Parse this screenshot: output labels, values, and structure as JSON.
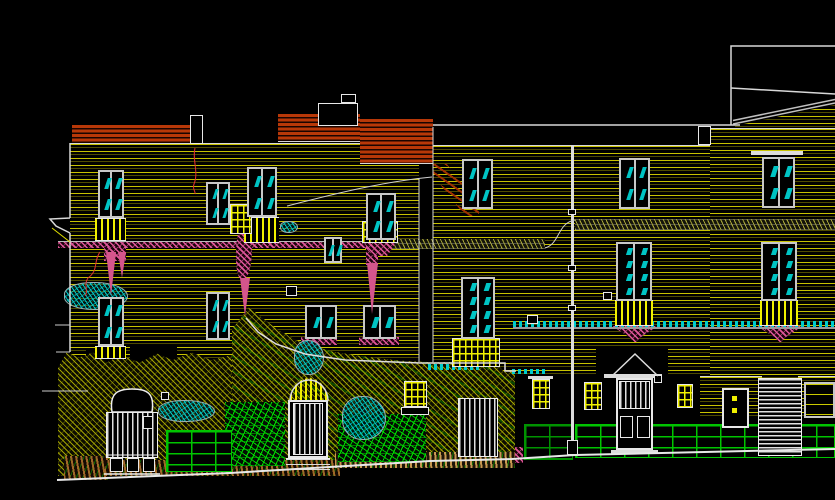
{
  "canvas": {
    "width": 835,
    "height": 500,
    "background": "#000000",
    "view_name": "street-elevation-cad-drawing"
  },
  "palette": {
    "course_yellow": "#d2cd00",
    "outline_white": "#d8d8d8",
    "brick_red": "#b83808",
    "hatch_pink": "#e0559a",
    "glazing_teal": "#00c4c4",
    "vegetation_olive": "#afaf00",
    "stone_green": "#00c400",
    "ground_brown": "#a06828",
    "crack_red": "#e03030"
  },
  "shapes": [
    {
      "name": "facade-courses-left",
      "cls": "courses",
      "x": 70,
      "y": 143,
      "w": 349,
      "h": 217
    },
    {
      "name": "facade-courses-right",
      "cls": "courses",
      "x": 433,
      "y": 145,
      "w": 277,
      "h": 230
    },
    {
      "name": "facade-courses-far-right",
      "cls": "courses",
      "x": 710,
      "y": 128,
      "w": 125,
      "h": 250
    },
    {
      "name": "roof-triangle-courses",
      "cls": "courses",
      "x": 735,
      "y": 101,
      "w": 100,
      "h": 27,
      "clip": "polygon(0 92%,100% 14%,100% 100%,0 100%)"
    },
    {
      "name": "courses-door5-wall",
      "cls": "courses",
      "x": 700,
      "y": 376,
      "w": 62,
      "h": 42
    },
    {
      "name": "courses-window20-wall",
      "cls": "courses",
      "x": 798,
      "y": 376,
      "w": 37,
      "h": 42
    },
    {
      "name": "party-recess-strip",
      "cls": "black",
      "x": 419,
      "y": 160,
      "w": 14,
      "h": 202
    },
    {
      "name": "pediment-backdrop",
      "cls": "black",
      "x": 596,
      "y": 348,
      "w": 72,
      "h": 30
    },
    {
      "name": "garden-pocket-1",
      "cls": "black",
      "x": 86,
      "y": 350,
      "w": 26,
      "h": 40
    },
    {
      "name": "garden-pocket-2",
      "cls": "black",
      "x": 130,
      "y": 346,
      "w": 47,
      "h": 42
    },
    {
      "name": "brick-parapet-left",
      "cls": "brick-red",
      "x": 72,
      "y": 125,
      "w": 118,
      "h": 19
    },
    {
      "name": "brick-parapet-mid",
      "cls": "brick-red",
      "x": 278,
      "y": 114,
      "w": 82,
      "h": 28
    },
    {
      "name": "brick-gable",
      "cls": "brick-red",
      "x": 360,
      "y": 119,
      "w": 73,
      "h": 45
    },
    {
      "name": "eaves-slope",
      "cls": "eaves",
      "x": 433,
      "y": 164,
      "w": 46,
      "h": 52,
      "clip": "polygon(0 0,30% 0,100% 78%,100% 100%,70% 100%,0 22%)"
    },
    {
      "name": "string-band-khaki-left",
      "cls": "hatch-khaki",
      "x": 365,
      "y": 239,
      "w": 180,
      "h": 10
    },
    {
      "name": "string-band-khaki-right",
      "cls": "hatch-khaki",
      "x": 575,
      "y": 219,
      "w": 260,
      "h": 11
    },
    {
      "name": "string-band-pink",
      "cls": "hatch-pink",
      "x": 58,
      "y": 241,
      "w": 308,
      "h": 7,
      "bt": "#bbbbbb"
    },
    {
      "name": "pink-drip-column",
      "cls": "hatch-pink",
      "x": 104,
      "y": 247,
      "w": 22,
      "h": 14
    },
    {
      "name": "downpipe-blob",
      "cls": "hatch-pink",
      "x": 236,
      "y": 224,
      "w": 16,
      "h": 56,
      "r": "55% 45% 60% 40%"
    },
    {
      "name": "downpipe-2-top",
      "cls": "hatch-pink",
      "x": 366,
      "y": 241,
      "w": 12,
      "h": 24
    },
    {
      "name": "corbel-window4",
      "cls": "hatch-pink",
      "x": 364,
      "y": 243,
      "w": 32,
      "h": 13,
      "clip": "polygon(0 0,100% 0,72% 100%,28% 100%)"
    },
    {
      "name": "corbel-window13",
      "cls": "hatch-pink",
      "x": 612,
      "y": 326,
      "w": 46,
      "h": 16,
      "clip": "polygon(0 0,100% 0,62% 70%,52% 100%,48% 100%,38% 70%)"
    },
    {
      "name": "corbel-window14",
      "cls": "hatch-pink",
      "x": 757,
      "y": 326,
      "w": 46,
      "h": 16,
      "clip": "polygon(0 0,100% 0,62% 70%,52% 100%,48% 100%,38% 70%)"
    },
    {
      "name": "sill-window10",
      "cls": "hatch-pink",
      "x": 301,
      "y": 337,
      "w": 36,
      "h": 8
    },
    {
      "name": "sill-window11",
      "cls": "hatch-pink",
      "x": 359,
      "y": 337,
      "w": 40,
      "h": 8
    },
    {
      "name": "pink-plinth-block",
      "cls": "hatch-pink",
      "x": 512,
      "y": 447,
      "w": 11,
      "h": 16
    },
    {
      "name": "garden-pink-patch",
      "cls": "hatch-pink",
      "x": 193,
      "y": 397,
      "w": 35,
      "h": 40,
      "clip": "polygon(15% 0,100% 25%,80% 100%,0 70%)"
    },
    {
      "name": "terrain-olive-left",
      "cls": "hatch-olive",
      "x": 58,
      "y": 350,
      "w": 174,
      "h": 126,
      "clip": "polygon(0 14%,5% 2%,12% 6%,20% 2%,28% 10%,36% 4%,47% 10%,57% 3%,66% 8%,77% 2%,88% 8%,100% 4%,100% 100%,0 100%)"
    },
    {
      "name": "terrain-olive-outbuilding",
      "cls": "hatch-olive2",
      "x": 232,
      "y": 306,
      "w": 283,
      "h": 156,
      "clip": "polygon(0 15%,6% 1%,11% 8%,16% 15%,24% 23%,35% 29%,45% 32%,59% 35%,70% 36%,93% 36%,96% 42%,100% 42%,100% 100%,0 100%)"
    },
    {
      "name": "ground-brown-corner",
      "cls": "ground-brown",
      "x": 64,
      "y": 456,
      "w": 44,
      "h": 24
    },
    {
      "name": "ground-brown-strip",
      "cls": "ground-brown",
      "x": 105,
      "y": 460,
      "w": 235,
      "h": 16
    },
    {
      "name": "ground-tan-path",
      "cls": "ground-tan",
      "x": 335,
      "y": 452,
      "w": 180,
      "h": 16
    },
    {
      "name": "stone-wall-left",
      "cls": "stone-green",
      "x": 225,
      "y": 402,
      "w": 60,
      "h": 64
    },
    {
      "name": "green-brick-wall-gate",
      "cls": "brick-green",
      "x": 166,
      "y": 430,
      "w": 66,
      "h": 42
    },
    {
      "name": "stone-wall-right",
      "cls": "stone-green",
      "x": 338,
      "y": 414,
      "w": 88,
      "h": 48
    },
    {
      "name": "green-brick-wall-dim",
      "cls": "brick-green",
      "x": 524,
      "y": 424,
      "w": 49,
      "h": 36,
      "op": 0.75
    },
    {
      "name": "green-brick-plinth-right",
      "cls": "brick-green",
      "x": 575,
      "y": 424,
      "w": 260,
      "h": 34
    },
    {
      "name": "ivy-bush-1",
      "cls": "bush-teal",
      "x": 64,
      "y": 282,
      "w": 64,
      "h": 28
    },
    {
      "name": "ivy-bush-2",
      "cls": "bush-teal",
      "x": 158,
      "y": 400,
      "w": 57,
      "h": 22
    },
    {
      "name": "ivy-bush-3",
      "cls": "bush-teal",
      "x": 342,
      "y": 396,
      "w": 44,
      "h": 44
    },
    {
      "name": "ivy-bush-4",
      "cls": "bush-teal",
      "x": 294,
      "y": 340,
      "w": 30,
      "h": 35
    },
    {
      "name": "ivy-squiggle",
      "cls": "bush-teal",
      "x": 280,
      "y": 221,
      "w": 18,
      "h": 12
    },
    {
      "name": "parapet-algae-1",
      "cls": "cable-teal",
      "x": 428,
      "y": 364,
      "w": 52,
      "h": 6
    },
    {
      "name": "parapet-algae-2",
      "cls": "cable-teal",
      "x": 512,
      "y": 369,
      "w": 35,
      "h": 5
    },
    {
      "name": "service-wire-bar",
      "cls": "cable",
      "x": 513,
      "y": 321,
      "w": 322,
      "h": 8
    },
    {
      "name": "wire-node-box",
      "cls": "outline-box",
      "x": 527,
      "y": 315,
      "w": 11,
      "h": 9
    },
    {
      "name": "balconette-window1",
      "cls": "balusters",
      "x": 95,
      "y": 218,
      "w": 31,
      "h": 23
    },
    {
      "name": "balconette-window3",
      "cls": "balusters",
      "x": 244,
      "y": 217,
      "w": 35,
      "h": 26
    },
    {
      "name": "oriel-grid-window2",
      "cls": "grid-yellow",
      "x": 230,
      "y": 204,
      "w": 22,
      "h": 30
    },
    {
      "name": "balcony-grid-window4",
      "cls": "grid-yellow",
      "x": 362,
      "y": 221,
      "w": 36,
      "h": 22
    },
    {
      "name": "sill-bars-window8",
      "cls": "balusters",
      "x": 95,
      "y": 346,
      "w": 31,
      "h": 13
    },
    {
      "name": "balconette-window13",
      "cls": "balusters",
      "x": 615,
      "y": 300,
      "w": 38,
      "h": 26
    },
    {
      "name": "balconette-window14",
      "cls": "balusters",
      "x": 760,
      "y": 300,
      "w": 38,
      "h": 26
    },
    {
      "name": "balcony-grid-window15",
      "cls": "grid-yellow",
      "x": 452,
      "y": 338,
      "w": 48,
      "h": 29
    },
    {
      "name": "door2-fanlight",
      "cls": "fan-yellow",
      "x": 290,
      "y": 378,
      "w": 38,
      "h": 23
    },
    {
      "name": "basement-grid-1",
      "cls": "grid-yellow",
      "x": 584,
      "y": 382,
      "w": 18,
      "h": 28
    },
    {
      "name": "basement-grid-2",
      "cls": "grid-yellow",
      "x": 677,
      "y": 384,
      "w": 16,
      "h": 24
    },
    {
      "name": "basement-grid-3",
      "cls": "grid-yellow",
      "x": 404,
      "y": 381,
      "w": 23,
      "h": 26
    },
    {
      "name": "planter-box",
      "cls": "outline-box",
      "x": 401,
      "y": 407,
      "w": 28,
      "h": 8
    },
    {
      "name": "basement-grid-4",
      "cls": "grid-yellow",
      "x": 532,
      "y": 379,
      "w": 18,
      "h": 30
    },
    {
      "name": "lintel-grid-4",
      "cls": "white-bar",
      "x": 528,
      "y": 376,
      "w": 25,
      "h": 3
    },
    {
      "name": "lintel-window7",
      "cls": "white-bar",
      "x": 751,
      "y": 151,
      "w": 52,
      "h": 4
    },
    {
      "name": "window-20",
      "cls": "window-plain",
      "x": 804,
      "y": 382,
      "w": 31,
      "h": 36
    },
    {
      "name": "gate-body",
      "cls": "slats-v",
      "x": 106,
      "y": 412,
      "w": 52,
      "h": 46
    },
    {
      "name": "gate-top-panel",
      "cls": "outline-box",
      "x": 117,
      "y": 394,
      "w": 31,
      "h": 15
    },
    {
      "name": "gate-panel-1",
      "cls": "outline-box",
      "x": 110,
      "y": 458,
      "w": 13,
      "h": 14
    },
    {
      "name": "gate-panel-2",
      "cls": "outline-box",
      "x": 127,
      "y": 458,
      "w": 12,
      "h": 14
    },
    {
      "name": "gate-panel-3",
      "cls": "outline-box",
      "x": 143,
      "y": 458,
      "w": 12,
      "h": 14
    },
    {
      "name": "gate-label-plate",
      "cls": "outline-box",
      "x": 143,
      "y": 416,
      "w": 10,
      "h": 13
    },
    {
      "name": "door2-frame",
      "cls": "door-frame",
      "x": 288,
      "y": 400,
      "w": 40,
      "h": 58
    },
    {
      "name": "door2-bars",
      "cls": "slats-v",
      "x": 293,
      "y": 403,
      "w": 30,
      "h": 52
    },
    {
      "name": "door2-steps",
      "cls": "steps",
      "x": 286,
      "y": 458,
      "w": 44,
      "h": 12
    },
    {
      "name": "door3-boarded",
      "cls": "slats-v",
      "x": 458,
      "y": 398,
      "w": 40,
      "h": 59
    },
    {
      "name": "door4-frame",
      "cls": "door-frame",
      "x": 616,
      "y": 378,
      "w": 37,
      "h": 72
    },
    {
      "name": "door4-bars",
      "cls": "slats-v",
      "x": 619,
      "y": 381,
      "w": 31,
      "h": 28
    },
    {
      "name": "door4-panel-1",
      "cls": "outline-box",
      "x": 620,
      "y": 416,
      "w": 13,
      "h": 22
    },
    {
      "name": "door4-panel-2",
      "cls": "outline-box",
      "x": 637,
      "y": 416,
      "w": 13,
      "h": 22
    },
    {
      "name": "door4-entablature",
      "cls": "white-bar",
      "x": 604,
      "y": 374,
      "w": 58,
      "h": 4
    },
    {
      "name": "door4-threshold",
      "cls": "white-bar",
      "x": 611,
      "y": 450,
      "w": 47,
      "h": 4
    },
    {
      "name": "door5-frame",
      "cls": "door-frame",
      "x": 722,
      "y": 388,
      "w": 27,
      "h": 40
    },
    {
      "name": "door5-knob-1",
      "cls": "yellow-dot",
      "x": 732,
      "y": 396,
      "w": 5,
      "h": 5
    },
    {
      "name": "door5-knob-2",
      "cls": "yellow-dot",
      "x": 732,
      "y": 408,
      "w": 5,
      "h": 5
    },
    {
      "name": "garage-door",
      "cls": "slats-h",
      "x": 758,
      "y": 378,
      "w": 44,
      "h": 78
    },
    {
      "name": "chimney",
      "cls": "outline-box",
      "x": 318,
      "y": 103,
      "w": 40,
      "h": 23
    },
    {
      "name": "chimney-cap",
      "cls": "outline-box",
      "x": 341,
      "y": 94,
      "w": 15,
      "h": 9
    },
    {
      "name": "parapet-box-left",
      "cls": "outline-box",
      "x": 190,
      "y": 115,
      "w": 13,
      "h": 29
    },
    {
      "name": "parapet-box-right",
      "cls": "outline-box",
      "x": 698,
      "y": 126,
      "w": 13,
      "h": 19
    },
    {
      "name": "party-wall-line",
      "cls": "white-bar",
      "x": 571,
      "y": 145,
      "w": 3,
      "h": 310
    },
    {
      "name": "party-node-1",
      "cls": "outline-box",
      "x": 568,
      "y": 209,
      "w": 8,
      "h": 6
    },
    {
      "name": "party-node-2",
      "cls": "outline-box",
      "x": 568,
      "y": 265,
      "w": 8,
      "h": 6
    },
    {
      "name": "party-node-3",
      "cls": "outline-box",
      "x": 568,
      "y": 305,
      "w": 8,
      "h": 6
    },
    {
      "name": "party-wall-base",
      "cls": "outline-box",
      "x": 567,
      "y": 440,
      "w": 11,
      "h": 15
    },
    {
      "name": "survey-marker-1",
      "cls": "outline-box",
      "x": 286,
      "y": 286,
      "w": 11,
      "h": 10
    },
    {
      "name": "survey-marker-2",
      "cls": "outline-box",
      "x": 603,
      "y": 292,
      "w": 9,
      "h": 8
    },
    {
      "name": "survey-marker-3",
      "cls": "outline-box",
      "x": 654,
      "y": 375,
      "w": 8,
      "h": 8
    },
    {
      "name": "survey-marker-4",
      "cls": "outline-box",
      "x": 161,
      "y": 392,
      "w": 8,
      "h": 8
    }
  ],
  "windows": [
    {
      "name": "window-1",
      "x": 98,
      "y": 170,
      "w": 26,
      "h": 48,
      "rows": 2
    },
    {
      "name": "window-2",
      "x": 206,
      "y": 182,
      "w": 24,
      "h": 43,
      "rows": 2
    },
    {
      "name": "window-3",
      "x": 247,
      "y": 167,
      "w": 30,
      "h": 50,
      "rows": 2
    },
    {
      "name": "window-4",
      "x": 366,
      "y": 193,
      "w": 30,
      "h": 47,
      "rows": 2
    },
    {
      "name": "window-5",
      "x": 462,
      "y": 159,
      "w": 31,
      "h": 50,
      "rows": 2
    },
    {
      "name": "window-6",
      "x": 619,
      "y": 158,
      "w": 31,
      "h": 51,
      "rows": 2
    },
    {
      "name": "window-7",
      "x": 762,
      "y": 157,
      "w": 33,
      "h": 51,
      "rows": 2
    },
    {
      "name": "window-8",
      "x": 98,
      "y": 297,
      "w": 26,
      "h": 49,
      "rows": 2
    },
    {
      "name": "window-9",
      "x": 206,
      "y": 292,
      "w": 24,
      "h": 48,
      "rows": 2
    },
    {
      "name": "window-10",
      "x": 305,
      "y": 305,
      "w": 32,
      "h": 34,
      "rows": 1
    },
    {
      "name": "window-11",
      "x": 363,
      "y": 305,
      "w": 33,
      "h": 34,
      "rows": 1
    },
    {
      "name": "window-12",
      "x": 324,
      "y": 237,
      "w": 18,
      "h": 26,
      "rows": 1
    },
    {
      "name": "window-13",
      "x": 616,
      "y": 242,
      "w": 36,
      "h": 59,
      "rows": 4
    },
    {
      "name": "window-14",
      "x": 761,
      "y": 242,
      "w": 36,
      "h": 59,
      "rows": 4
    },
    {
      "name": "window-15",
      "x": 461,
      "y": 277,
      "w": 34,
      "h": 62,
      "rows": 4
    }
  ],
  "paths": [
    {
      "name": "ground-line",
      "d": "M57,480 L230,473 L430,461 L512,459 L575,455 L835,449",
      "stroke": "#e8e8e8",
      "w": 2
    },
    {
      "name": "parapet-long-line",
      "d": "M433,125 L740,125",
      "stroke": "#d8d8d8",
      "w": 1.5
    },
    {
      "name": "roof-outline-topright",
      "d": "M731,125 L731,46 L835,46",
      "stroke": "#d8d8d8",
      "w": 1.5
    },
    {
      "name": "roof-ridge-line",
      "d": "M731,88 L835,94",
      "stroke": "#d8d8d8",
      "w": 1.5
    },
    {
      "name": "roof-diagonal-1",
      "d": "M733,124 L835,103",
      "stroke": "#c0c0c0",
      "w": 1.5
    },
    {
      "name": "roof-diagonal-2",
      "d": "M733,120.5 L835,99.5",
      "stroke": "#c0c0c0",
      "w": 1.5
    },
    {
      "name": "left-facade-edge",
      "d": "M70,143 L70,218 M70,218 L50,219 L56,226 L70,233 M70,233 L70,352",
      "stroke": "#d8d8d8",
      "w": 1.5
    },
    {
      "name": "cornice-yellow-line",
      "d": "M52,228 L70,242",
      "stroke": "#e0e000",
      "w": 1
    },
    {
      "name": "recess-left-edge",
      "d": "M419,178 L419,362",
      "stroke": "#d8d8d8",
      "w": 1
    },
    {
      "name": "recess-right-edge",
      "d": "M433,127 L433,362",
      "stroke": "#d8d8d8",
      "w": 1
    },
    {
      "name": "telephone-wire-curve",
      "d": "M287,206 C330,195 380,182 432,177",
      "stroke": "#cfcfcf",
      "w": 1
    },
    {
      "name": "band-s-connector",
      "d": "M545,248 C560,244 557,223 575,220",
      "stroke": "#cfcfcf",
      "w": 1
    },
    {
      "name": "crack-line-1",
      "d": "M100,252 C93,262 99,270 88,278 C83,285 89,290 85,296",
      "stroke": "#e03030",
      "w": 1
    },
    {
      "name": "crack-line-2",
      "d": "M195,148 C192,160 199,172 194,184 C192,189 196,192 195,194",
      "stroke": "#e03030",
      "w": 1
    },
    {
      "name": "door4-pediment",
      "d": "M612,376 L635,354 L658,376",
      "stroke": "#dddddd",
      "w": 1.5
    },
    {
      "name": "gate-mansard-top",
      "d": "M112,412 C109,393 118,389 132,389 C147,389 155,393 152,412 Z",
      "stroke": "#eeeeee",
      "w": 1.5,
      "fill": "#000000"
    },
    {
      "name": "door2-arch",
      "d": "M290,401 A19,21 0 0 1 328,401",
      "stroke": "#dddddd",
      "w": 1.5
    },
    {
      "name": "pink-drip-1",
      "d": "M106,252 L111,296 L116,252 Z",
      "stroke": "none",
      "w": 0,
      "fill": "#d4558c"
    },
    {
      "name": "pink-drip-2",
      "d": "M118,252 L122,278 L126,252 Z",
      "stroke": "none",
      "w": 0,
      "fill": "#d4558c"
    },
    {
      "name": "downpipe-spike-1",
      "d": "M240,278 L245,316 L250,278 Z",
      "stroke": "none",
      "w": 0,
      "fill": "#d4558c"
    },
    {
      "name": "downpipe-spike-2",
      "d": "M367,263 L372,314 L378,263 Z",
      "stroke": "none",
      "w": 0,
      "fill": "#d4558c"
    },
    {
      "name": "outbuilding-parapet",
      "d": "M246,318 L258,332 L276,344 L305,354 L345,360 L420,363 L505,363 L505,371 L516,371",
      "stroke": "#dddddd",
      "w": 1.5
    },
    {
      "name": "gate-ground-line",
      "d": "M104,474 L160,474",
      "stroke": "#eeeeee",
      "w": 1.5
    },
    {
      "name": "gate-rail-line",
      "d": "M106,455 L158,455",
      "stroke": "#eeeeee",
      "w": 1
    },
    {
      "name": "left-tick-1",
      "d": "M55,325 L70,325",
      "stroke": "#cccccc",
      "w": 1
    },
    {
      "name": "left-tick-2",
      "d": "M56,352 L70,352",
      "stroke": "#cccccc",
      "w": 1
    },
    {
      "name": "left-tick-3",
      "d": "M42,391 L88,391",
      "stroke": "#cccccc",
      "w": 1
    }
  ]
}
